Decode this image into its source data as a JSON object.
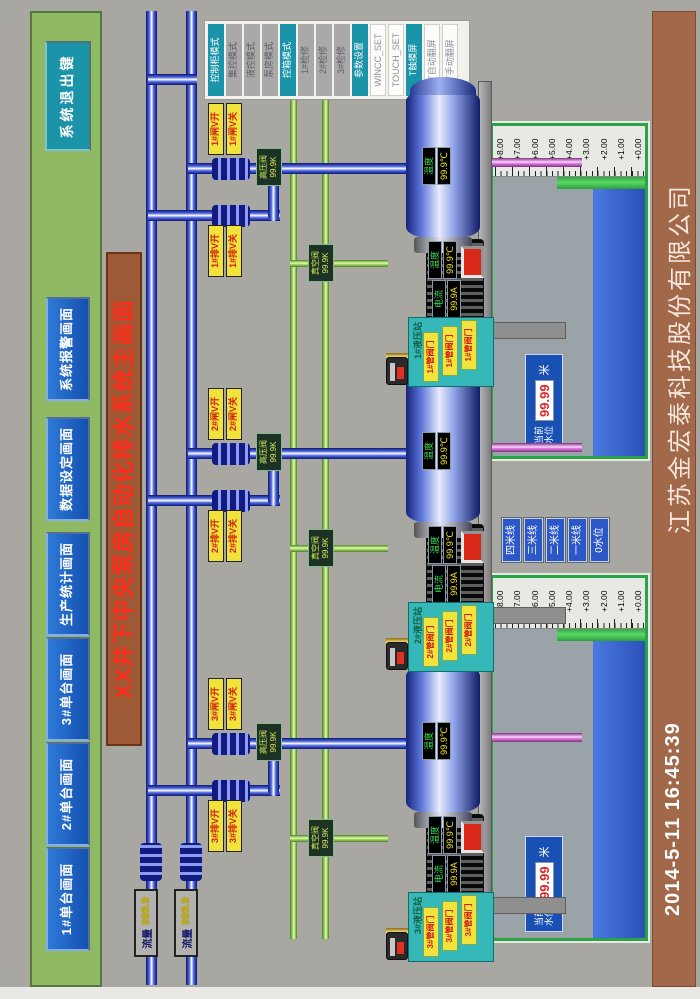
{
  "screen": {
    "title": "XX井下中央泵房自动化排水系统主画面",
    "company": "江苏金宏泰科技股份有限公司",
    "datetime": "2014-5-11  16:45:39"
  },
  "nav": {
    "buttons": [
      "1#单台画面",
      "2#单台画面",
      "3#单台画面",
      "生产统计画面",
      "数据设定画面",
      "系统报警画面"
    ],
    "exit_label": "系统退出键"
  },
  "mode_panel": {
    "buttons": [
      {
        "label": "控制柜模式",
        "style": "teal"
      },
      {
        "label": "集控模式",
        "style": "gray"
      },
      {
        "label": "液控模式",
        "style": "gray"
      },
      {
        "label": "泵房模式",
        "style": "gray"
      },
      {
        "label": "控箱模式",
        "style": "teal"
      },
      {
        "label": "1#检修",
        "style": "gray"
      },
      {
        "label": "2#检修",
        "style": "gray"
      },
      {
        "label": "3#检修",
        "style": "gray"
      },
      {
        "label": "参数设置",
        "style": "teal"
      },
      {
        "label": "WINCC_SET",
        "style": "white"
      },
      {
        "label": "TOUCH_SET",
        "style": "white"
      },
      {
        "label": "T触摸屏",
        "style": "teal"
      },
      {
        "label": "T自动翻屏",
        "style": "white"
      },
      {
        "label": "T手动翻屏",
        "style": "white"
      }
    ]
  },
  "flow_gauges": [
    {
      "label": "流量",
      "value": "999.9"
    },
    {
      "label": "流量",
      "value": "999.9"
    }
  ],
  "stations": [
    {
      "name": "1#",
      "gate_open": "1#闸V开",
      "gate_close": "1#闸V关",
      "drain_open": "1#排V开",
      "drain_close": "1#排V关",
      "discharge_label": "高压阀",
      "discharge_value": "99.9K",
      "vacuum_label": "真空阀",
      "vacuum_value": "99.9K",
      "pump_temp_label": "温度",
      "pump_temp_value": "99.9℃",
      "motor_current_label": "电流",
      "motor_current_value": "99.9A",
      "motor_temp_label": "温度",
      "motor_temp_value": "99.9℃",
      "hyd_title": "1#液压站",
      "hyd_buttons": [
        "1#管阀门",
        "1#管阀门",
        "1#管阀门"
      ]
    },
    {
      "name": "2#",
      "gate_open": "2#闸V开",
      "gate_close": "2#闸V关",
      "drain_open": "2#排V开",
      "drain_close": "2#排V关",
      "discharge_label": "高压阀",
      "discharge_value": "99.9K",
      "vacuum_label": "真空阀",
      "vacuum_value": "99.9K",
      "pump_temp_label": "温度",
      "pump_temp_value": "99.9℃",
      "motor_current_label": "电流",
      "motor_current_value": "99.9A",
      "motor_temp_label": "温度",
      "motor_temp_value": "99.9℃",
      "hyd_title": "2#液压站",
      "hyd_buttons": [
        "2#管阀门",
        "2#管阀门",
        "2#管阀门"
      ]
    },
    {
      "name": "3#",
      "gate_open": "3#闸V开",
      "gate_close": "3#闸V关",
      "drain_open": "3#排V开",
      "drain_close": "3#排V关",
      "discharge_label": "高压阀",
      "discharge_value": "99.9K",
      "vacuum_label": "真空阀",
      "vacuum_value": "99.9K",
      "pump_temp_label": "温度",
      "pump_temp_value": "99.9℃",
      "motor_current_label": "电流",
      "motor_current_value": "99.9A",
      "motor_temp_label": "温度",
      "motor_temp_value": "99.9℃",
      "hyd_title": "3#液压站",
      "hyd_buttons": [
        "3#管阀门",
        "3#管阀门",
        "3#管阀门"
      ]
    }
  ],
  "tanks": [
    {
      "scale": [
        "+8.00",
        "+7.00",
        "+6.00",
        "+5.00",
        "+4.00",
        "+3.00",
        "+2.00",
        "+1.00",
        "+0.00"
      ],
      "level_label_top": "当前",
      "level_label_bottom": "水位",
      "level_value": "99.99",
      "unit": "米"
    },
    {
      "scale": [
        "+8.00",
        "+7.00",
        "+6.00",
        "+5.00",
        "+4.00",
        "+3.00",
        "+2.00",
        "+1.00",
        "+0.00"
      ],
      "level_label_top": "当前",
      "level_label_bottom": "水位",
      "level_value": "99.99",
      "unit": "米"
    }
  ],
  "level_buttons": [
    "四米线",
    "三米线",
    "二米线",
    "一米线",
    "0水位"
  ],
  "colors": {
    "accent_teal": "#1b93a8",
    "nav_blue": "#1a5cc4",
    "title_red": "#ff2a1a",
    "panel_green": "#8fb963",
    "bar_brown": "#a2684a",
    "pipe_blue": "#2038b8",
    "pipe_green": "#9cd162",
    "suction_pink": "#d277d2",
    "water_blue": "#3a66cc",
    "alarm_red": "#d82818"
  }
}
